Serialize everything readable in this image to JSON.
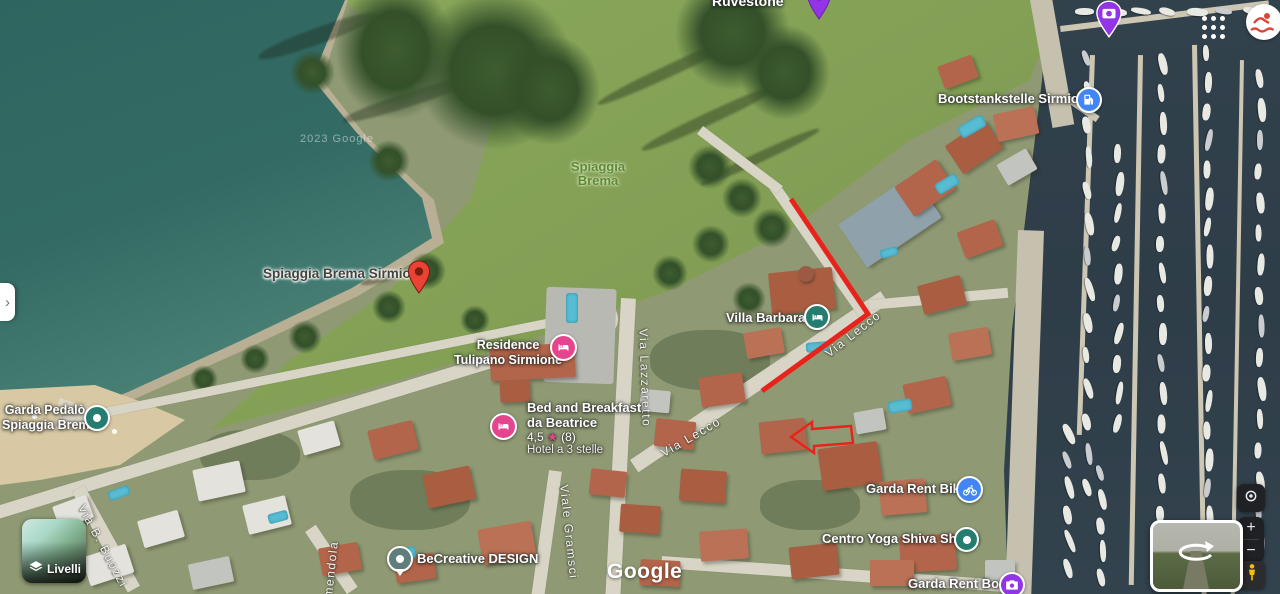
{
  "pois": {
    "ruvestone": {
      "label": "Ruvestone"
    },
    "bootstankstelle": {
      "label": "Bootstankstelle Sirmione"
    },
    "spiaggia_park": {
      "line1": "Spiaggia",
      "line2": "Brema"
    },
    "spiaggia_pin": {
      "label": "Spiaggia Brema Sirmione"
    },
    "villa_barbara": {
      "label": "Villa Barbara"
    },
    "tulipano": {
      "line1": "Residence",
      "line2": "Tulipano Sirmione"
    },
    "beatrice": {
      "line1": "Bed and Breakfast",
      "line2": "da Beatrice",
      "rating": "4,5",
      "star_icon": "★",
      "reviews": "(8)",
      "category": "Hotel a 3 stelle"
    },
    "garda_pedalo": {
      "line1": "Garda Pedalò",
      "line2": "Spiaggia Brema"
    },
    "rent_bikes": {
      "label": "Garda Rent Bikes"
    },
    "yoga": {
      "label": "Centro Yoga Shiva Shakti"
    },
    "rent_boat": {
      "label": "Garda Rent Boat"
    },
    "becreative": {
      "label": "BeCreative DESIGN"
    }
  },
  "streets": {
    "lazzaretto": "Via Lazzaretto",
    "lecco_upper": "Via Lecco",
    "lecco_lower": "Via Lecco",
    "gramsci": "Viale Gramsci",
    "buozzi": "Via B. Buozzi",
    "amendola": "mendola"
  },
  "controls": {
    "layers_label": "Livelli",
    "zoom_in": "+",
    "zoom_out": "−",
    "panel_toggle": "›"
  },
  "logo": "Google",
  "watermark": "2023 Google",
  "colors": {
    "pin_red": "#ea4335",
    "hotel_pink": "#e5458f",
    "lodging_teal": "#257d70",
    "becreative_teal": "#5f7d7b",
    "poi_blue": "#4285f4",
    "attraction_purple": "#9334e6",
    "annotation_red": "#e8231c",
    "park_label_green": "#5c8a33"
  }
}
